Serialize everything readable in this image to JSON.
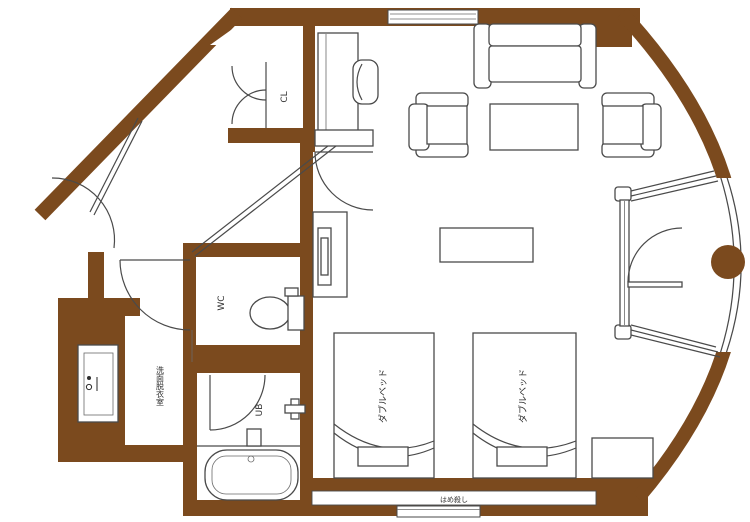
{
  "plan": {
    "labels": {
      "closet": "CL",
      "toilet_room": "WC",
      "unit_bath": "UB",
      "washroom": "洗面脱衣室",
      "bed1": "ダブルベッド",
      "bed2": "ダブルベッド",
      "window_note": "はめ殺し"
    },
    "colors": {
      "wall": "#7b4a1e",
      "line": "#4a4a4a",
      "floor": "#ffffff"
    }
  }
}
